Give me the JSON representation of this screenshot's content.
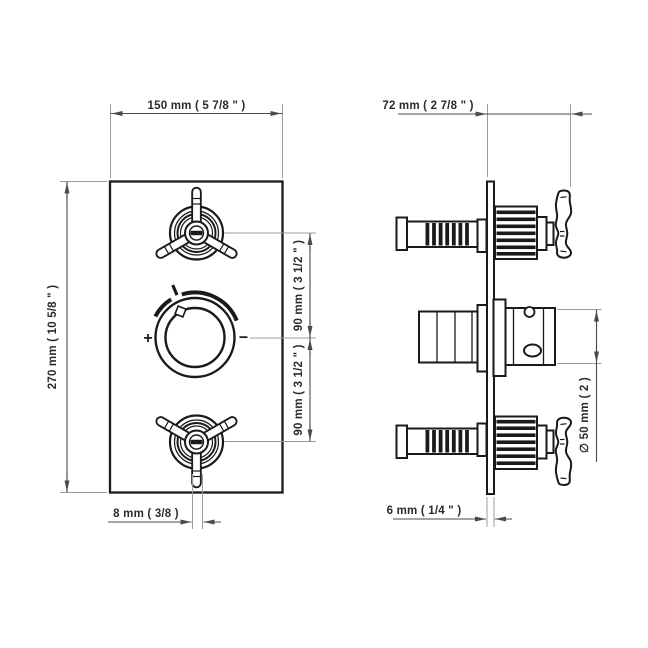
{
  "colors": {
    "background": "#ffffff",
    "outline": "#1a1a1a",
    "dimension_line": "#4a4a4a",
    "extension_line": "#9c9c9c",
    "text": "#2b2b2b"
  },
  "front_view": {
    "width_label": "150 mm ( 5 7/8 \" )",
    "height_label": "270 mm ( 10 5/8 \" )",
    "upper_spacing_label": "90 mm ( 3 1/2 \" )",
    "lower_spacing_label": "90 mm ( 3 1/2 \" )",
    "lever_offset_label": "8 mm ( 3/8 )",
    "knob_plus": "+",
    "knob_minus": "−"
  },
  "side_view": {
    "depth_label": "72 mm ( 2 7/8 \" )",
    "plate_thickness_label": "6 mm ( 1/4 \" )",
    "knob_diameter_label": "∅ 50 mm ( 2 )"
  }
}
